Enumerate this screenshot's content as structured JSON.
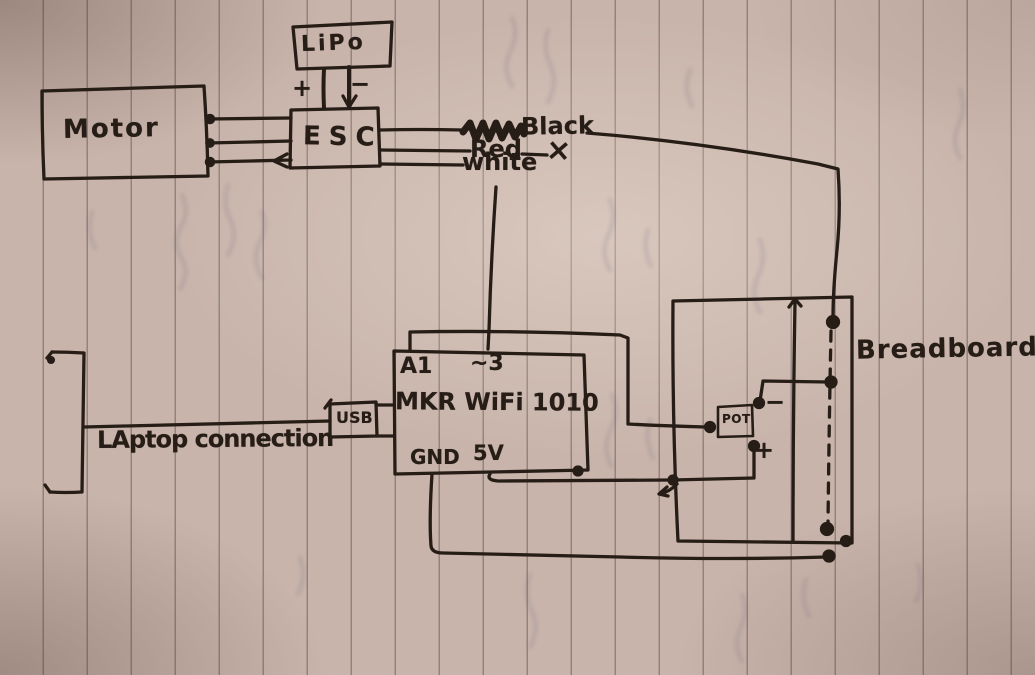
{
  "colors": {
    "ink": "#271d17",
    "paper": "#c8b4aa",
    "rule_line": "#685a58"
  },
  "components": {
    "lipo": {
      "label": "LiPo",
      "plus": "+",
      "minus": "−"
    },
    "motor": {
      "label": "Motor"
    },
    "esc": {
      "label": "ESC"
    },
    "mkr_board": {
      "label": "MKR WiFi 1010",
      "pins": {
        "a1": "A1",
        "d3": "~3",
        "gnd": "GND",
        "v5": "5V"
      },
      "usb": "USB"
    },
    "laptop": {
      "label": "LAptop connection"
    },
    "potentiometer": {
      "label": "POT",
      "plus": "+",
      "minus": "−"
    },
    "breadboard": {
      "label": "Breadboard"
    }
  },
  "wires": {
    "black": {
      "label": "Black"
    },
    "red": {
      "label": "Red",
      "terminator": "×"
    },
    "white": {
      "label": "white"
    }
  }
}
